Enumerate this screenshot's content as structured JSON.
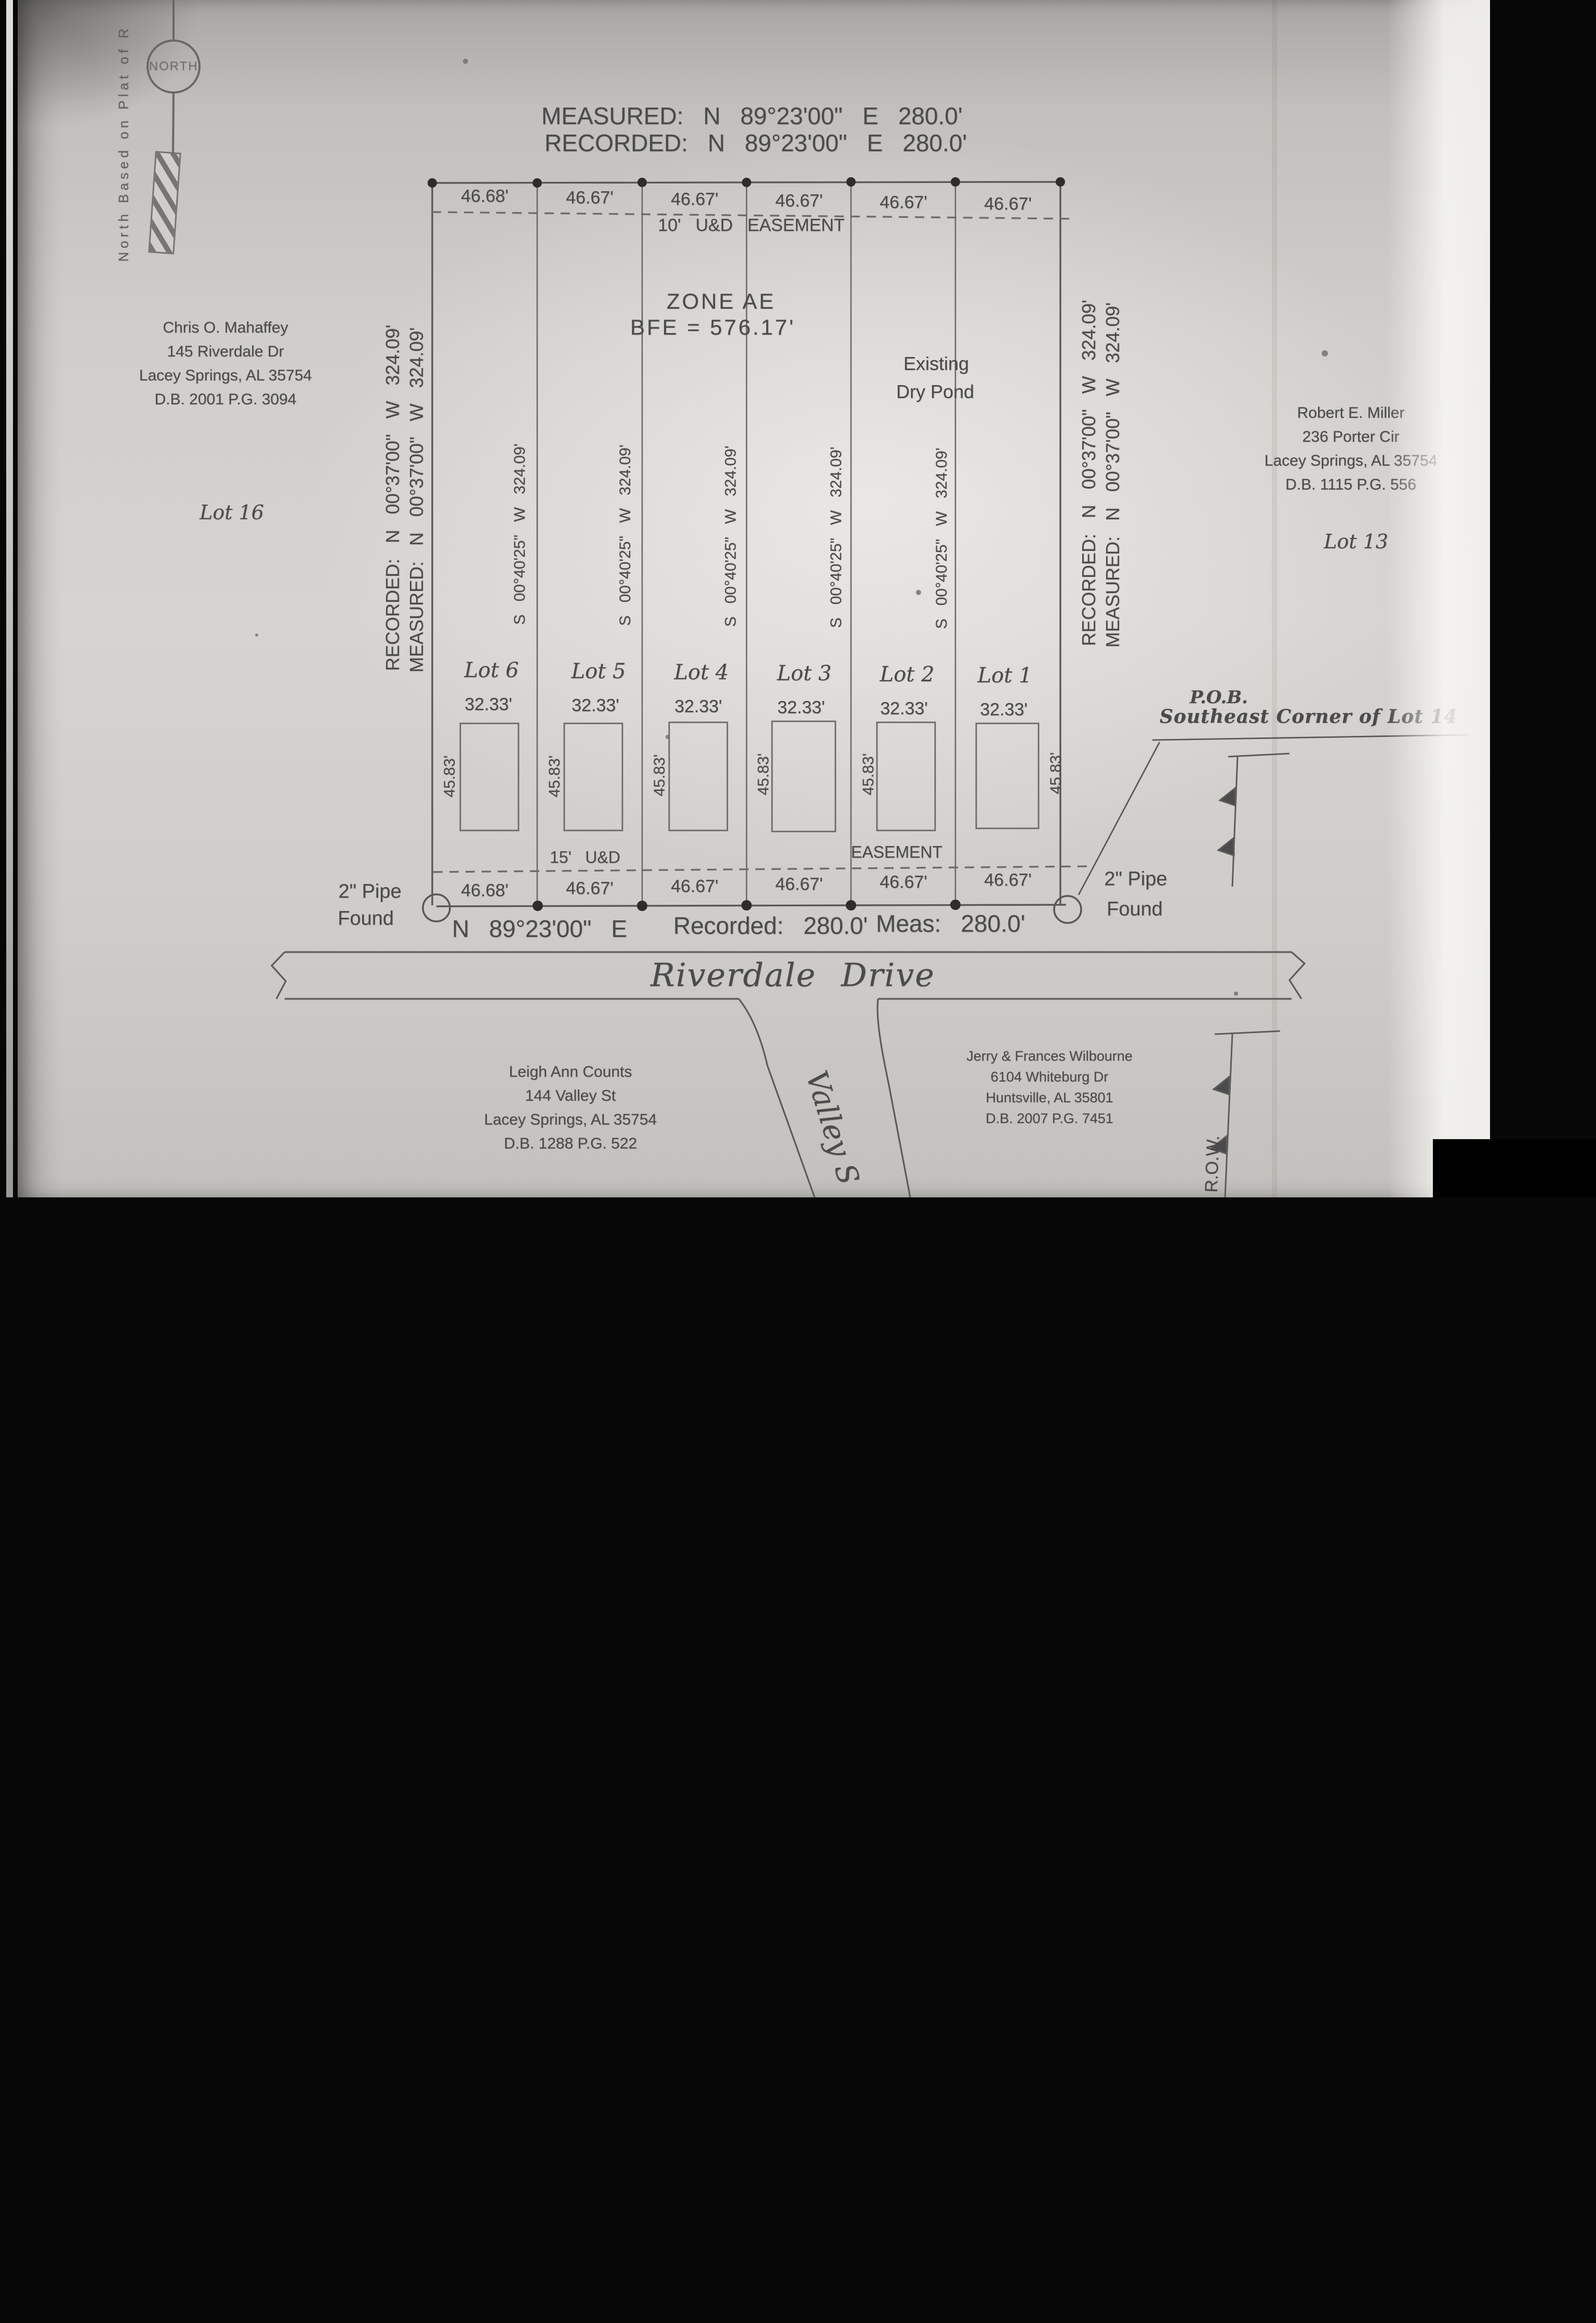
{
  "header": {
    "measured": "MEASURED: N 89°23'00\" E 280.0'",
    "recorded": "RECORDED: N 89°23'00\" E 280.0'"
  },
  "north": {
    "circle_label": "NORTH",
    "side_note": "North Based on Plat of R"
  },
  "easements": {
    "top": "10' U&D EASEMENT",
    "bottom_left": "15' U&D",
    "bottom_right": "EASEMENT"
  },
  "zone": {
    "line1": "ZONE AE",
    "line2": "BFE = 576.17'"
  },
  "pond": {
    "line1": "Existing",
    "line2": "Dry Pond"
  },
  "boundary_left": {
    "recorded": "RECORDED: N 00°37'00\" W 324.09'",
    "measured": "MEASURED: N 00°37'00\" W 324.09'"
  },
  "boundary_right": {
    "recorded": "RECORDED: N 00°37'00\" W 324.09'",
    "measured": "MEASURED: N 00°37'00\" W 324.09'"
  },
  "lot_line_bearing": "S 00°40'25\" W 324.09'",
  "lots": [
    {
      "name": "Lot 6",
      "width_top": "46.68'",
      "width_bottom": "46.68'",
      "frontage": "32.33'",
      "building_width": "45.83'"
    },
    {
      "name": "Lot 5",
      "width_top": "46.67'",
      "width_bottom": "46.67'",
      "frontage": "32.33'",
      "building_width": "45.83'"
    },
    {
      "name": "Lot 4",
      "width_top": "46.67'",
      "width_bottom": "46.67'",
      "frontage": "32.33'",
      "building_width": "45.83'"
    },
    {
      "name": "Lot 3",
      "width_top": "46.67'",
      "width_bottom": "46.67'",
      "frontage": "32.33'",
      "building_width": "45.83'"
    },
    {
      "name": "Lot 2",
      "width_top": "46.67'",
      "width_bottom": "46.67'",
      "frontage": "32.33'",
      "building_width": "45.83'"
    },
    {
      "name": "Lot 1",
      "width_top": "46.67'",
      "width_bottom": "46.67'",
      "frontage": "32.33'",
      "building_width": "45.83'"
    }
  ],
  "adjacent": {
    "left": "Lot 16",
    "right": "Lot 13"
  },
  "neighbors": {
    "northwest": [
      "Chris O. Mahaffey",
      "145 Riverdale Dr",
      "Lacey Springs, AL 35754",
      "D.B. 2001 P.G. 3094"
    ],
    "northeast": [
      "Robert E. Miller",
      "236 Porter Cir",
      "Lacey Springs, AL 35754",
      "D.B. 1115 P.G. 556"
    ],
    "southwest": [
      "Leigh Ann Counts",
      "144 Valley St",
      "Lacey Springs, AL 35754",
      "D.B. 1288 P.G. 522"
    ],
    "southeast": [
      "Jerry & Frances Wilbourne",
      "6104 Whiteburg Dr",
      "Huntsville, AL 35801",
      "D.B. 2007 P.G. 7451"
    ]
  },
  "pob": {
    "line1": "P.O.B.",
    "line2": "Southeast Corner of Lot 14"
  },
  "pipes": {
    "left_line1": "2\" Pipe",
    "left_line2": "Found",
    "right_line1": "2\" Pipe",
    "right_line2": "Found"
  },
  "south_line": {
    "bearing": "N 89°23'00\" E",
    "recorded": "Recorded: 280.0'",
    "measured": "Meas: 280.0'"
  },
  "streets": {
    "main": "Riverdale Drive",
    "side": "Valley S",
    "row": "R.O.W."
  },
  "logo": {
    "name": "Valley",
    "suffix": "mls.com",
    "color": "#2d74b0"
  }
}
